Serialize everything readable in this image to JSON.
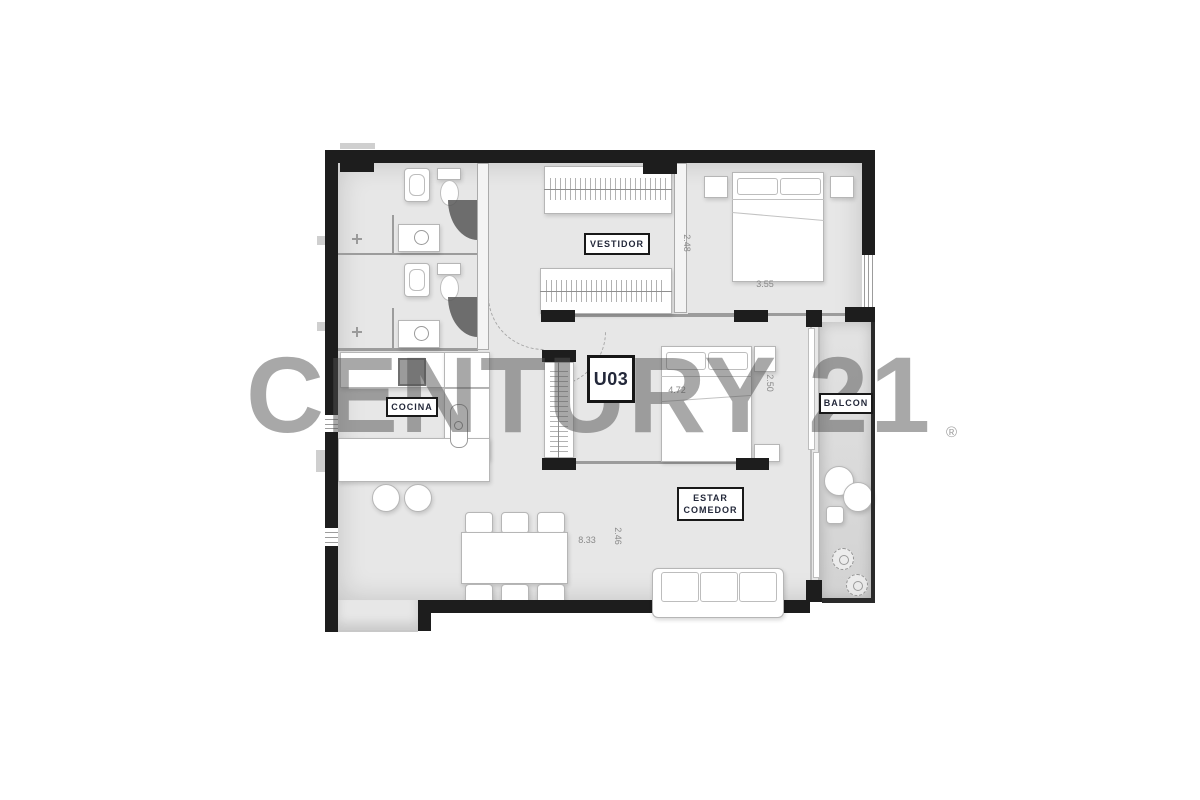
{
  "watermark": {
    "text": "CENTURY 21",
    "registered": "®",
    "color": "#9e9e9e"
  },
  "unit": {
    "label": "U03"
  },
  "rooms": {
    "vestidor": "VESTIDOR",
    "cocina": "COCINA",
    "balcon": "BALCON",
    "estar_comedor": "ESTAR\nCOMEDOR"
  },
  "dimensions": {
    "vestidor_depth": "2.48",
    "bedroom_width": "3.55",
    "living_width": "4.72",
    "bedroom2_depth": "2.50",
    "plan_width": "8.33",
    "living_depth": "2.46"
  },
  "colors": {
    "wall": "#1d1d1d",
    "floor": "#e7e7e7",
    "label_text": "#23283a",
    "dim_text": "#8a8a8a"
  }
}
